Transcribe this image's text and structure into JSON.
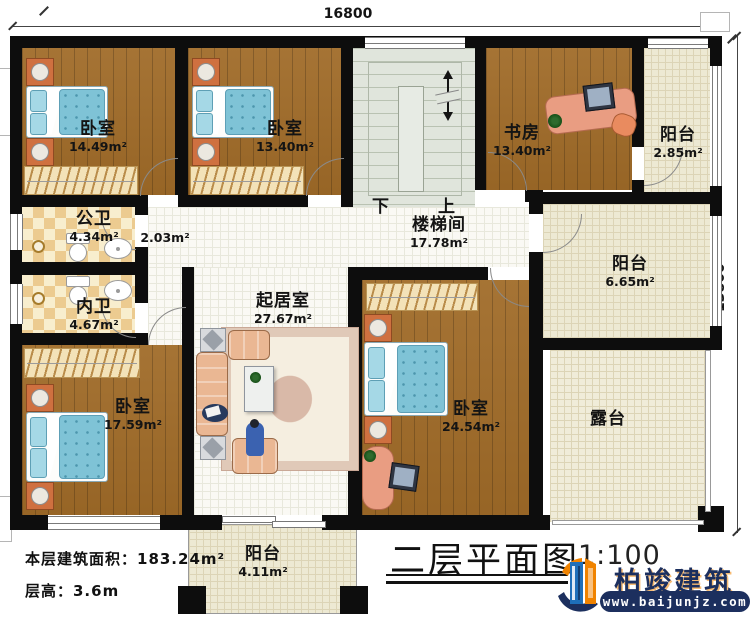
{
  "dimensions": {
    "top": "16800",
    "right": "13800"
  },
  "rooms": {
    "bedroom_tl": {
      "name": "卧室",
      "area": "14.49m²"
    },
    "bedroom_tm": {
      "name": "卧室",
      "area": "13.40m²"
    },
    "study": {
      "name": "书房",
      "area": "13.40m²"
    },
    "balcony_tr": {
      "name": "阳台",
      "area": "2.85m²"
    },
    "public_bath": {
      "name": "公卫",
      "area": "4.34m²"
    },
    "hallway": {
      "area": "2.03m²"
    },
    "private_bath": {
      "name": "内卫",
      "area": "4.67m²"
    },
    "stair_hall": {
      "name": "楼梯间",
      "area": "17.78m²"
    },
    "living": {
      "name": "起居室",
      "area": "27.67m²"
    },
    "bedroom_bl": {
      "name": "卧室",
      "area": "17.59m²"
    },
    "bedroom_br": {
      "name": "卧室",
      "area": "24.54m²"
    },
    "balcony_r": {
      "name": "阳台",
      "area": "6.65m²"
    },
    "terrace": {
      "name": "露台"
    },
    "balcony_b": {
      "name": "阳台",
      "area": "4.11m²"
    }
  },
  "stairs": {
    "down_label": "下",
    "up_label": "上"
  },
  "info": {
    "floor_area": "本层建筑面积：183.24m²",
    "floor_height": "层高：3.6m"
  },
  "title_block": {
    "title": "二层平面图",
    "scale": "1:100"
  },
  "logo": {
    "brand": "柏竣建筑",
    "website": "www.baijunjz.com"
  },
  "colors": {
    "wall": "#0d0d0d",
    "wood": "#a06b28",
    "bed_blue": "#7fc3d6",
    "brand_navy": "#1c2f5e",
    "brand_blue": "#1e6fba",
    "brand_orange": "#f08300"
  }
}
